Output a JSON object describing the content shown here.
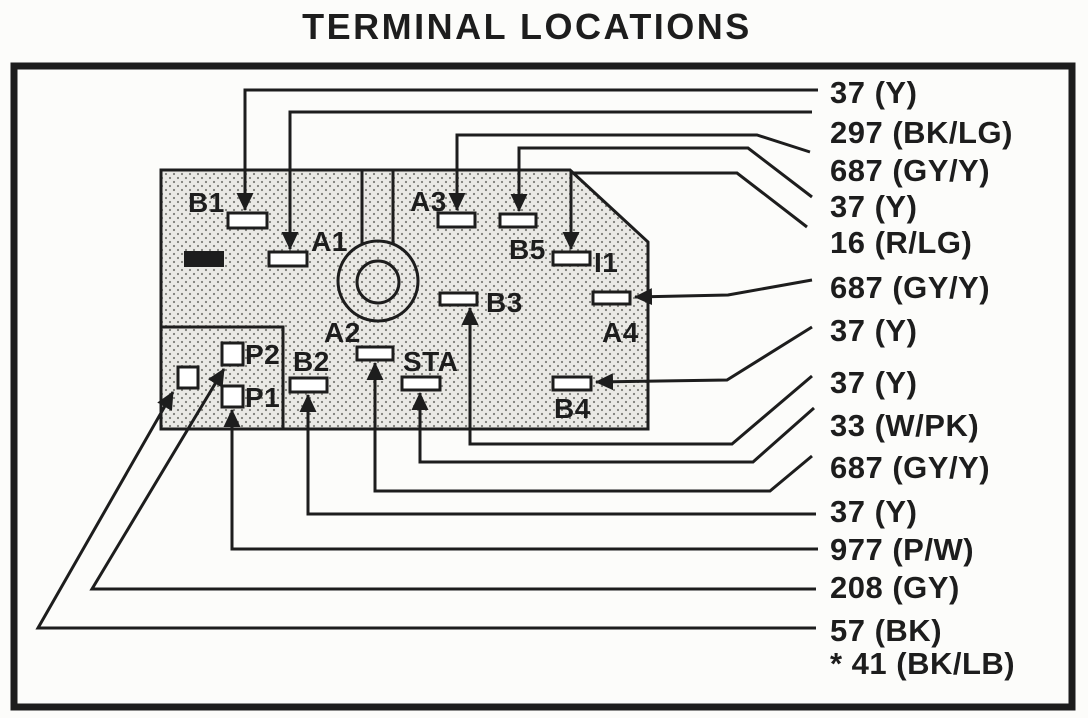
{
  "title": "TERMINAL LOCATIONS",
  "colors": {
    "ink": "#1d1d1d",
    "paper": "#fcfcfa",
    "stipple_background": "#eae9e5",
    "stipple_dot": "#7d7d78"
  },
  "terminals": [
    {
      "id": "B1"
    },
    {
      "id": "A1"
    },
    {
      "id": "A3"
    },
    {
      "id": "B5"
    },
    {
      "id": "I1"
    },
    {
      "id": "B3"
    },
    {
      "id": "A4"
    },
    {
      "id": "A2"
    },
    {
      "id": "B2"
    },
    {
      "id": "STA"
    },
    {
      "id": "B4"
    },
    {
      "id": "P2"
    },
    {
      "id": "P1"
    }
  ],
  "wires": [
    {
      "label": "37 (Y)",
      "terminal": "B1"
    },
    {
      "label": "297 (BK/LG)",
      "terminal": "A1"
    },
    {
      "label": "687 (GY/Y)",
      "terminal": "A3"
    },
    {
      "label": "37 (Y)",
      "terminal": "B5"
    },
    {
      "label": "16 (R/LG)",
      "terminal": "I1"
    },
    {
      "label": "687 (GY/Y)",
      "terminal": "A4"
    },
    {
      "label": "37 (Y)",
      "terminal": "B4"
    },
    {
      "label": "37 (Y)",
      "terminal": "B3"
    },
    {
      "label": "33 (W/PK)",
      "terminal": "STA"
    },
    {
      "label": "687 (GY/Y)",
      "terminal": "A2"
    },
    {
      "label": "37 (Y)",
      "terminal": "B2"
    },
    {
      "label": "977 (P/W)",
      "terminal": "P1"
    },
    {
      "label": "208 (GY)",
      "terminal": "P2"
    },
    {
      "label": "57 (BK)",
      "terminal": ""
    },
    {
      "label": "* 41 (BK/LB)",
      "terminal": ""
    }
  ]
}
